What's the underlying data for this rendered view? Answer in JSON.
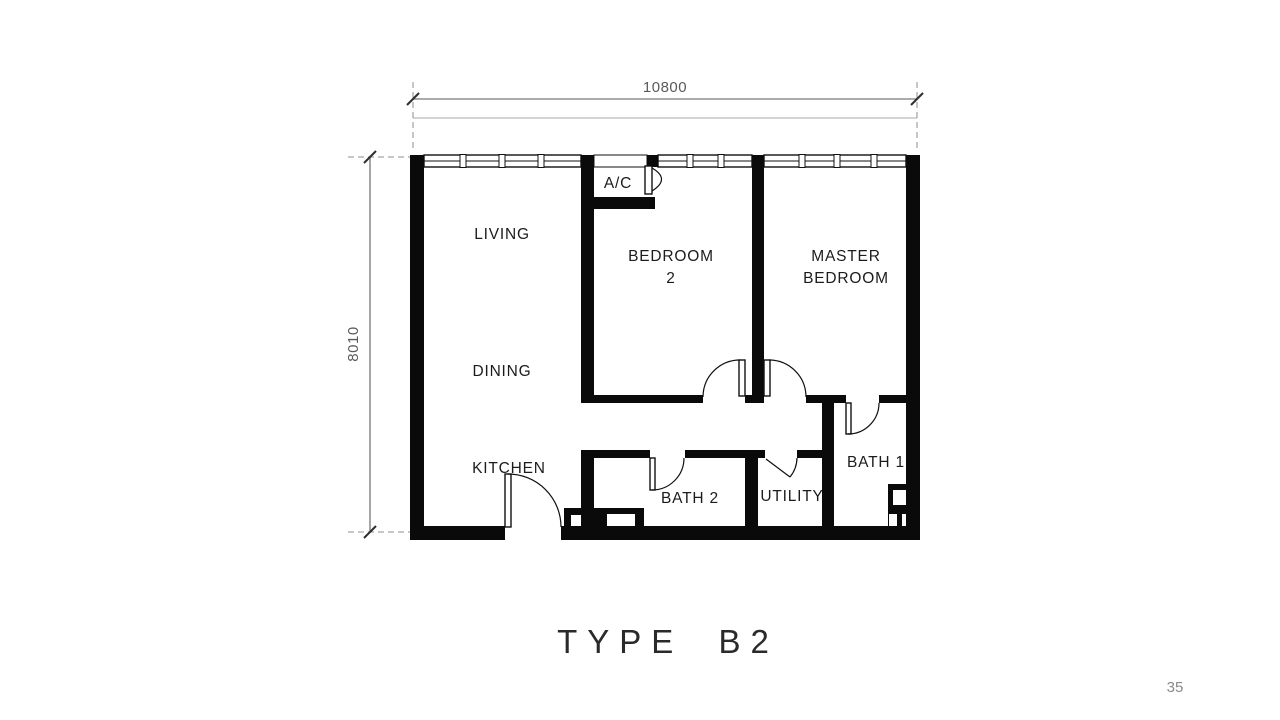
{
  "plan": {
    "title": "TYPE B2",
    "page_number": "35",
    "dimensions": {
      "width": "10800",
      "height": "8010"
    },
    "rooms": {
      "living": "LIVING",
      "dining": "DINING",
      "kitchen": "KITCHEN",
      "ac": "A/C",
      "bedroom2_line1": "BEDROOM",
      "bedroom2_line2": "2",
      "master_line1": "MASTER",
      "master_line2": "BEDROOM",
      "bath2": "BATH 2",
      "utility": "UTILITY",
      "bath1": "BATH 1"
    },
    "colors": {
      "background": "#ffffff",
      "wall": "#0a0a0a",
      "label_text": "#1c1c1c",
      "dimension_line": "#8f8f8f",
      "dimension_text": "#5a5a5a",
      "title_text": "#2a2a2a",
      "page_number_text": "#8a8a8a"
    }
  }
}
